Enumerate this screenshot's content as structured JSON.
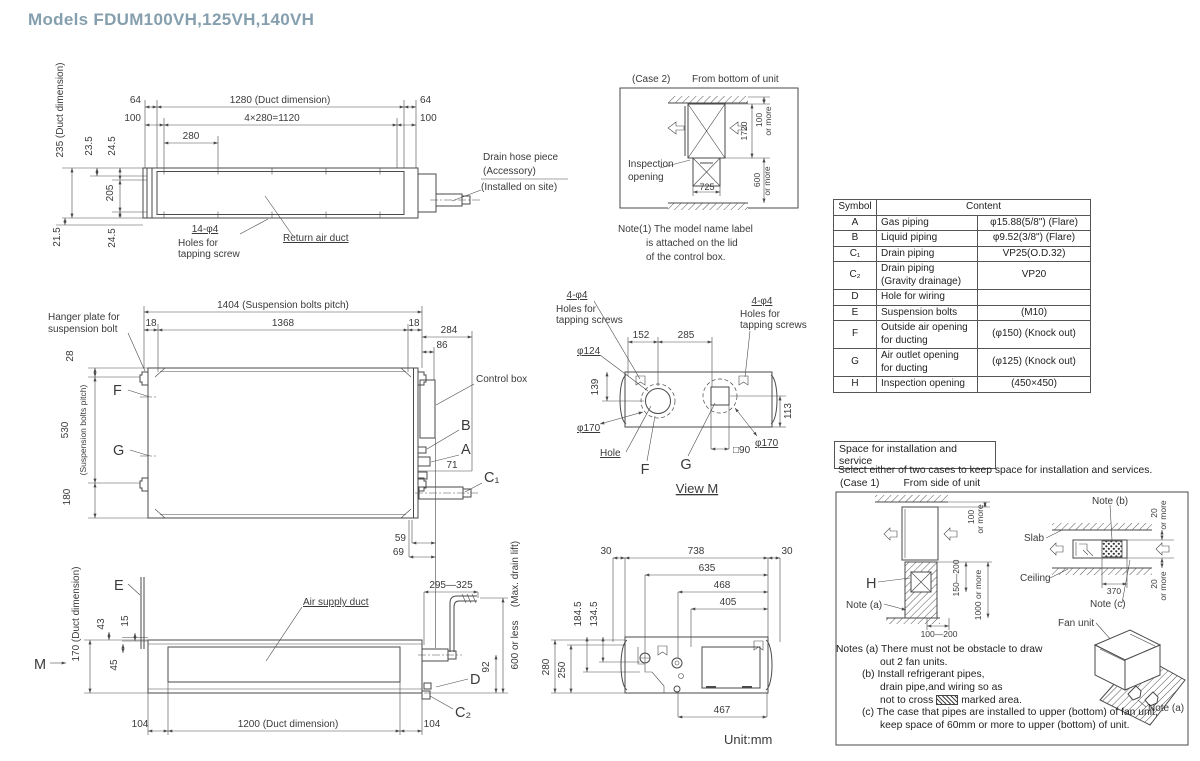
{
  "title": "Models  FDUM100VH,125VH,140VH",
  "unit_label": "Unit:mm",
  "colors": {
    "title": "#859fae",
    "line": "#4a4a4a",
    "text": "#333333"
  },
  "top_view": {
    "d64_left": "64",
    "d100_left": "100",
    "d1280": "1280 (Duct dimension)",
    "d4x280": "4×280=1120",
    "d280": "280",
    "d64_right": "64",
    "d100_right": "100",
    "d235": "235 (Duct dimension)",
    "d23_5": "23.5",
    "d24_5_top": "24.5",
    "d205": "205",
    "d21_5": "21.5",
    "d24_5_bottom": "24.5",
    "holes_qty": "14-φ4",
    "holes_line1": "Holes for",
    "holes_line2": "tapping screw",
    "return_air_duct": "Return air duct",
    "drain_line1": "Drain hose piece",
    "drain_line2": "(Accessory)",
    "drain_line3": "(Installed on site)"
  },
  "case2": {
    "label": "(Case 2)",
    "subtitle": "From bottom of unit",
    "inspection_line1": "Inspection",
    "inspection_line2": "opening",
    "d100": "100",
    "d100_more": "or more",
    "d1720": "1720",
    "d600": "600",
    "d600_more": "or more",
    "d725": "725",
    "note_line1": "Note(1)  The model name label",
    "note_line2": "is attached on the lid",
    "note_line3": "of the control box."
  },
  "symbol_table": {
    "col_symbol": "Symbol",
    "col_content": "Content",
    "rows": [
      {
        "symbol": "A",
        "name": "Gas piping",
        "name2": "",
        "value": "φ15.88(5/8\") (Flare)"
      },
      {
        "symbol": "B",
        "name": "Liquid piping",
        "name2": "",
        "value": "φ9.52(3/8\") (Flare)"
      },
      {
        "symbol": "C₁",
        "name": "Drain piping",
        "name2": "",
        "value": "VP25(O.D.32)"
      },
      {
        "symbol": "C₂",
        "name": "Drain piping",
        "name2": "(Gravity drainage)",
        "value": "VP20"
      },
      {
        "symbol": "D",
        "name": "Hole for wiring",
        "name2": "",
        "value": ""
      },
      {
        "symbol": "E",
        "name": "Suspension bolts",
        "name2": "",
        "value": "(M10)"
      },
      {
        "symbol": "F",
        "name": "Outside air opening",
        "name2": "for ducting",
        "value": "(φ150) (Knock out)"
      },
      {
        "symbol": "G",
        "name": "Air outlet opening",
        "name2": "for ducting",
        "value": "(φ125) (Knock out)"
      },
      {
        "symbol": "H",
        "name": "Inspection opening",
        "name2": "",
        "value": "(450×450)"
      }
    ]
  },
  "plan_view": {
    "d1404": "1404 (Suspension bolts pitch)",
    "d18_left": "18",
    "d1368": "1368",
    "d18_right": "18",
    "d284": "284",
    "d86": "86",
    "hanger_line1": "Hanger plate for",
    "hanger_line2": "suspension bolt",
    "d28": "28",
    "d530": "530",
    "pitch_label": "(Suspension bolts pitch)",
    "d180": "180",
    "f": "F",
    "g": "G",
    "control_box": "Control box",
    "b": "B",
    "a": "A",
    "d71": "71",
    "c1": "C₁",
    "d59": "59",
    "d69": "69"
  },
  "view_m": {
    "left_holes_qty": "4-φ4",
    "left_holes_line1": "Holes for",
    "left_holes_line2": "tapping screws",
    "right_holes_qty": "4-φ4",
    "right_holes_line1": "Holes for",
    "right_holes_line2": "tapping screws",
    "d152": "152",
    "d285": "285",
    "d124": "φ124",
    "d139": "139",
    "d170_left": "φ170",
    "d170_right": "φ170",
    "d113": "113",
    "hole": "Hole",
    "f": "F",
    "g": "G",
    "d90": "□90",
    "title": "View M"
  },
  "front_view": {
    "e": "E",
    "m": "M",
    "d170": "170 (Duct dimension)",
    "d43": "43",
    "d15": "15",
    "d45": "45",
    "air_supply_duct": "Air supply duct",
    "d104_left": "104",
    "d1200": "1200 (Duct dimension)",
    "d104_right": "104",
    "d295_325": "295—325",
    "max_drain_lift": "(Max. drain lift)",
    "d600_or_less": "600 or less",
    "d92": "92",
    "d_label": "D",
    "c2": "C₂"
  },
  "bottom_view": {
    "d30_left": "30",
    "d738": "738",
    "d30_right": "30",
    "d635": "635",
    "d468": "468",
    "d405": "405",
    "d184_5": "184.5",
    "d134_5": "134.5",
    "d280": "280",
    "d250": "250",
    "d467": "467"
  },
  "install": {
    "header": "Space for installation and service",
    "intro": "Select either of two cases to keep space for installation and services.",
    "case1": "(Case 1)",
    "case1_sub": "From side of unit",
    "d100": "100",
    "d100_more": "or more",
    "h": "H",
    "note_a": "Note (a)",
    "d150_200": "150—200",
    "d1000_more": "1000 or more",
    "d100_200": "100—200",
    "slab": "Slab",
    "ceiling": "Ceiling",
    "note_b": "Note (b)",
    "d20_top": "20",
    "d20_top_more": "or more",
    "d370": "370",
    "d20_bottom": "20",
    "d20_bottom_more": "or more",
    "note_c": "Note (c)",
    "fan_unit": "Fan unit",
    "note_a2": "Note (a)",
    "n_a1": "Notes (a)  There must not be obstacle to draw",
    "n_a2": "out 2 fan units.",
    "n_b1": "(b)  Install refrigerant pipes,",
    "n_b2": "drain pipe,and wiring so as",
    "n_b3_pre": "not to cross",
    "n_b3_post": "marked area.",
    "n_c1": "(c)  The case that pipes are installed to upper (bottom) of fan unit,",
    "n_c2": "keep space of 60mm or more to upper (bottom) of unit."
  }
}
